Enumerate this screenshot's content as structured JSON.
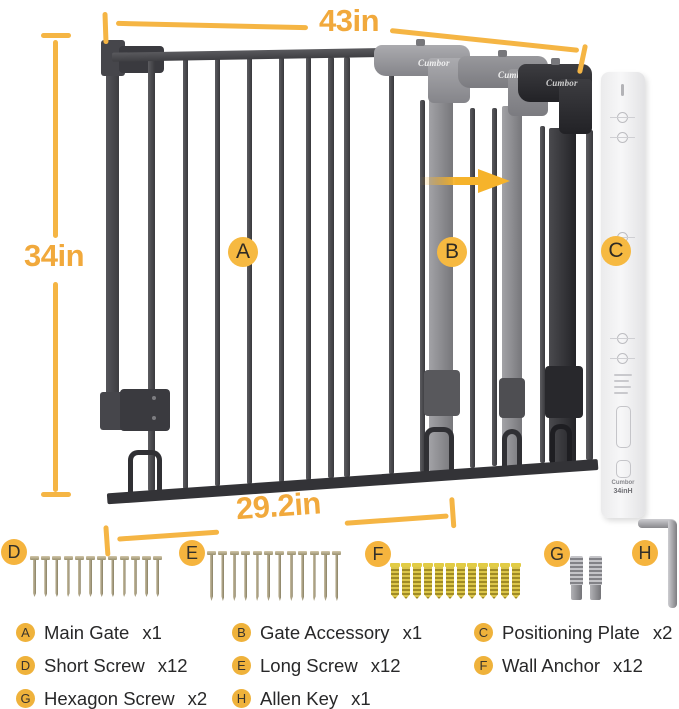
{
  "brand": "Cumbor",
  "accent_color": "#F5B440",
  "dimensions": {
    "total_width": "43in",
    "height": "34in",
    "gate_width": "29.2in"
  },
  "callouts": [
    {
      "letter": "A"
    },
    {
      "letter": "B"
    },
    {
      "letter": "C"
    }
  ],
  "hardware_groups": [
    {
      "letter": "D",
      "item": "short-screw",
      "count": 12
    },
    {
      "letter": "E",
      "item": "long-screw",
      "count": 12
    },
    {
      "letter": "F",
      "item": "wall-anchor",
      "count": 12
    },
    {
      "letter": "G",
      "item": "hexagon-screw",
      "count": 2
    },
    {
      "letter": "H",
      "item": "allen-key",
      "count": 1
    }
  ],
  "legend": [
    {
      "letter": "A",
      "name": "Main Gate",
      "qty": "x1"
    },
    {
      "letter": "B",
      "name": "Gate Accessory",
      "qty": "x1"
    },
    {
      "letter": "C",
      "name": "Positioning Plate",
      "qty": "x2"
    },
    {
      "letter": "D",
      "name": "Short Screw",
      "qty": "x12"
    },
    {
      "letter": "E",
      "name": "Long Screw",
      "qty": "x12"
    },
    {
      "letter": "F",
      "name": "Wall Anchor",
      "qty": "x12"
    },
    {
      "letter": "G",
      "name": "Hexagon Screw",
      "qty": "x2"
    },
    {
      "letter": "H",
      "name": "Allen Key",
      "qty": "x1"
    }
  ],
  "positioning_plate": {
    "size_label": "34inH"
  }
}
